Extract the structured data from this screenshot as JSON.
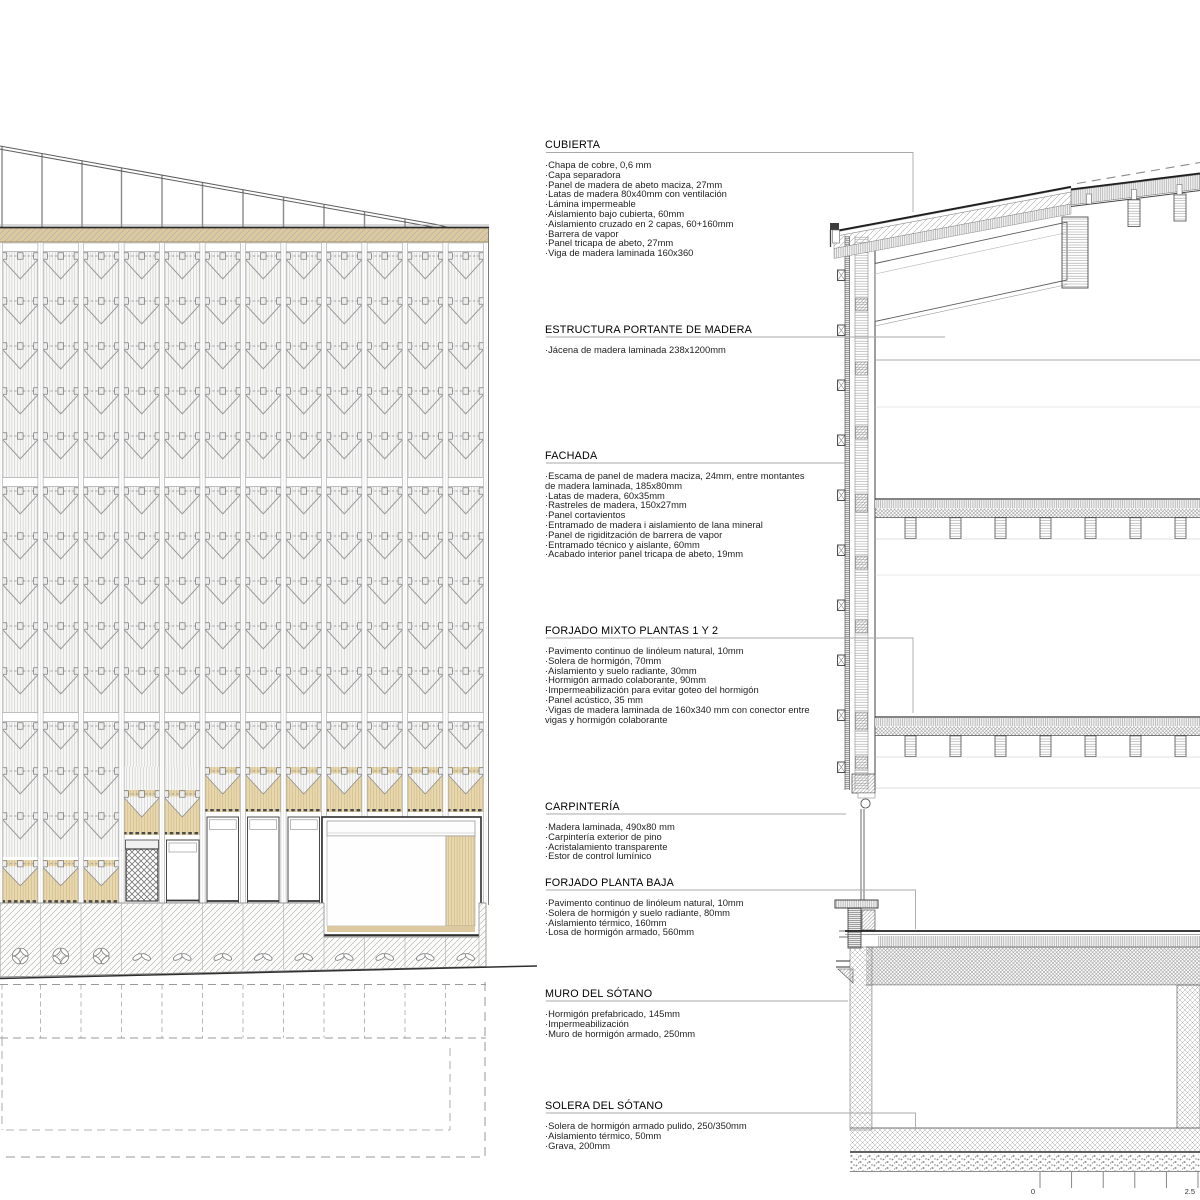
{
  "annotations": {
    "blocks": [
      {
        "title": "CUBIERTA",
        "items": [
          "·Chapa de cobre, 0,6 mm",
          "·Capa separadora",
          "·Panel de madera de abeto maciza, 27mm",
          "·Latas de madera 80x40mm con ventilación",
          "·Lámina impermeable",
          "·Aislamiento bajo cubierta, 60mm",
          "·Aislamiento cruzado en 2 capas, 60+160mm",
          "·Barrera de vapor",
          "·Panel tricapa de abeto, 27mm",
          "·Viga de madera laminada 160x360"
        ]
      },
      {
        "title": "ESTRUCTURA PORTANTE DE MADERA",
        "items": [
          "·Jácena de madera laminada 238x1200mm"
        ]
      },
      {
        "title": "FACHADA",
        "items": [
          "·Escama de panel de madera maciza, 24mm, entre montantes",
          "de madera laminada, 185x80mm",
          "·Latas de madera, 60x35mm",
          "·Rastreles de madera, 150x27mm",
          "·Panel cortavientos",
          "·Entramado de madera i aislamiento de lana mineral",
          "·Panel de rigiditzación de barrera de vapor",
          "·Entramado técnico y aislante, 60mm",
          "·Acabado interior panel tricapa de abeto, 19mm"
        ]
      },
      {
        "title": "FORJADO MIXTO PLANTAS 1 Y 2",
        "items": [
          "·Pavimento continuo de linóleum natural, 10mm",
          "·Solera de hormigón, 70mm",
          "·Aislamiento y suelo radiante, 30mm",
          "·Hormigón armado colaborante, 90mm",
          "·Impermeabilización para evitar goteo del hormigón",
          "·Panel acústico, 35 mm",
          "·Vigas de madera laminada de 160x340 mm con conector entre",
          "vigas y hormigón colaborante"
        ]
      },
      {
        "title": "CARPINTERÍA",
        "items": [
          "·Madera laminada, 490x80 mm",
          "·Carpintería exterior de pino",
          "·Acristalamiento transparente",
          "·Estor de control lumínico"
        ]
      },
      {
        "title": "FORJADO PLANTA BAJA",
        "items": [
          "·Pavimento continuo de linóleum natural, 10mm",
          "·Solera de hormigón y suelo radiante, 80mm",
          "·Aislamiento térmico, 160mm",
          "·Losa de hormigón armado, 560mm"
        ]
      },
      {
        "title": "MURO DEL SÓTANO",
        "items": [
          "·Hormigón prefabricado, 145mm",
          "·Impermeabilización",
          "·Muro de hormigón armado, 250mm"
        ]
      },
      {
        "title": "SOLERA DEL SÓTANO",
        "items": [
          "·Solera de hormigón armado pulido, 250/350mm",
          "·Aislamiento térmico, 50mm",
          "·Grava, 200mm"
        ]
      }
    ]
  },
  "scale_bar": {
    "start": "0",
    "end": "2.5"
  },
  "colors": {
    "wood": "#ddc9a0",
    "wood_light": "#e9d9b0",
    "leader_gray": "#a8a8a8",
    "line_dark": "#222222"
  }
}
